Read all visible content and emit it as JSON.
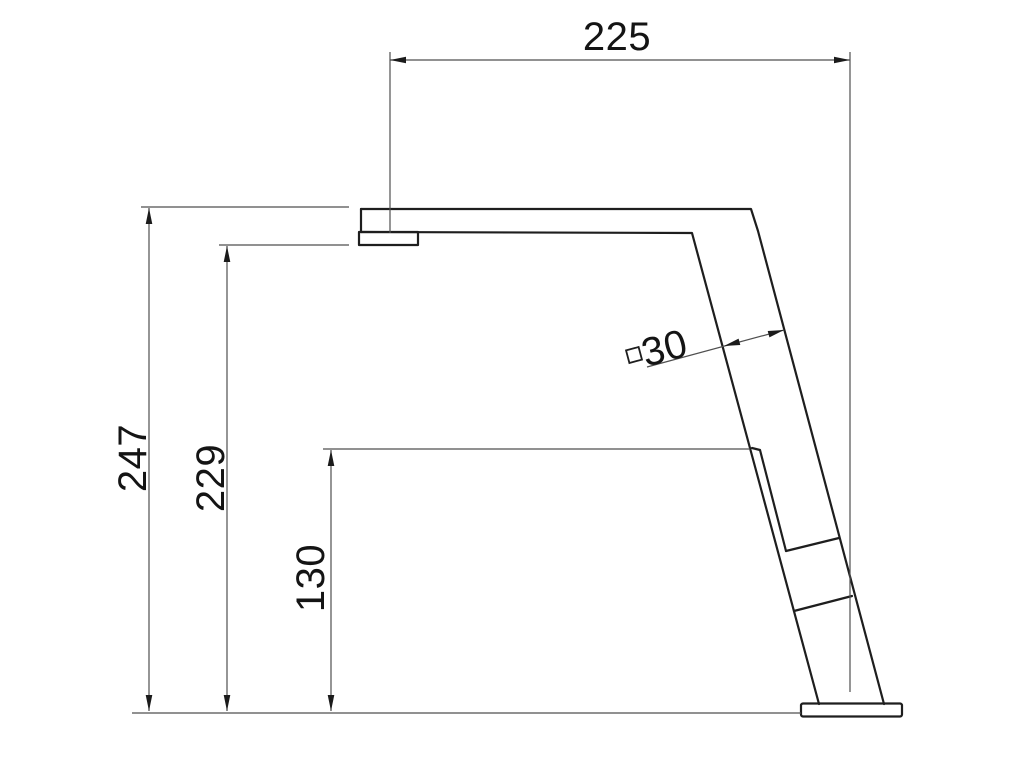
{
  "page": {
    "background": "#ffffff"
  },
  "drawing": {
    "type": "technical-dimension-drawing",
    "subject": "faucet-side-elevation",
    "colors": {
      "outline": "#1e1e1e",
      "dimension_line": "#4f4f4f",
      "text": "#141414"
    },
    "labels": {
      "reach": "225",
      "total_height": "247",
      "outlet_height": "229",
      "lever_height": "130",
      "body_section": "30"
    },
    "symbols": {
      "body_section_prefix": "square-section"
    }
  }
}
